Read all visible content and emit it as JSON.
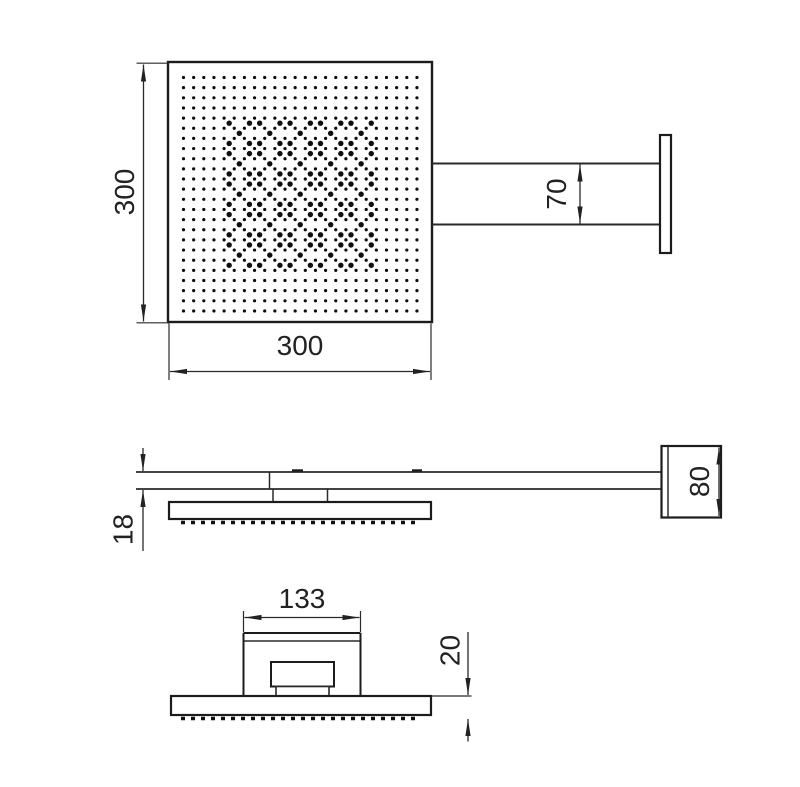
{
  "drawing": {
    "dims": {
      "head_height": "300",
      "head_width": "300",
      "arm_width": "70",
      "arm_thickness": "18",
      "wall_bracket_height": "80",
      "mount_bracket_width": "133",
      "head_edge_height": "20"
    }
  }
}
